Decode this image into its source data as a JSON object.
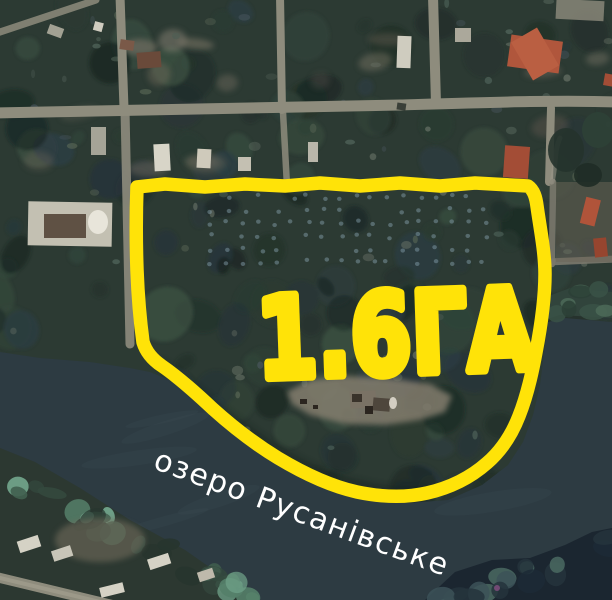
{
  "map": {
    "area_label": "1.6ГА",
    "water_label": "озеро Русанівське",
    "annotation_color": "#ffe308",
    "water_label_color": "#ffffff"
  }
}
